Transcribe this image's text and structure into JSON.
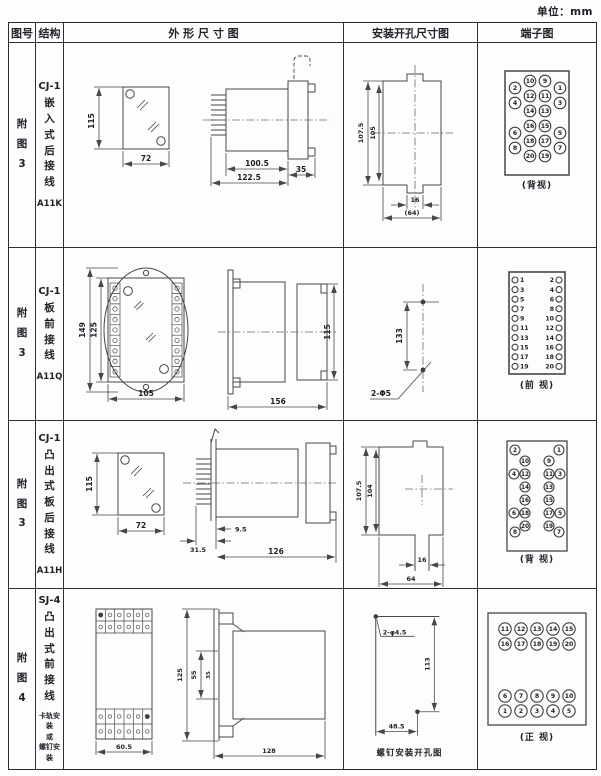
{
  "unit": "单位：mm",
  "header": {
    "fig": "图号",
    "structure": "结构",
    "outline": "外 形 尺 寸 图",
    "install": "安装开孔尺寸图",
    "terminal": "端子图"
  },
  "rows": [
    {
      "fig": "附图3",
      "model": "CJ-1",
      "mounting": "嵌入式后接线",
      "code": "A11K",
      "outline": {
        "h": "115",
        "w": "72",
        "body": "100.5",
        "total": "122.5",
        "flange": "35"
      },
      "install": {
        "outer_h": "107.5",
        "inner_h": "105",
        "slot_w": "16",
        "width": "(64)"
      },
      "terminal": {
        "view": "(背视)",
        "outer_left": [
          "2",
          "4",
          "6",
          "8"
        ],
        "mid_left": [
          "10",
          "12",
          "14",
          "16",
          "18",
          "20"
        ],
        "mid_right": [
          "9",
          "11",
          "13",
          "15",
          "17",
          "19"
        ],
        "outer_right": [
          "1",
          "3",
          "5",
          "7"
        ]
      }
    },
    {
      "fig": "附图3",
      "model": "CJ-1",
      "mounting": "板前接线",
      "code": "A11Q",
      "outline": {
        "outer_h": "149",
        "inner_h": "125",
        "w": "105",
        "len": "156",
        "side_h": "115"
      },
      "install": {
        "dist": "133",
        "holes": "2-Φ5"
      },
      "terminal": {
        "view": "(前 视)",
        "left": [
          "1",
          "3",
          "5",
          "7",
          "9",
          "11",
          "13",
          "15",
          "17",
          "19"
        ],
        "right": [
          "2",
          "4",
          "6",
          "8",
          "10",
          "12",
          "14",
          "16",
          "18",
          "20"
        ]
      }
    },
    {
      "fig": "附图3",
      "model": "CJ-1",
      "mounting": "凸出式板后接线",
      "code": "A11H",
      "outline": {
        "h": "115",
        "w": "72",
        "pins": "31.5",
        "offset": "9.5",
        "len": "126"
      },
      "install": {
        "outer_h": "107.5",
        "inner_h": "104",
        "slot_w": "16",
        "width": "64"
      },
      "terminal": {
        "view": "(背 视)",
        "top_left": "2",
        "top_right": "1",
        "bottom_left": "8",
        "bottom_right": "7",
        "mid_left": [
          "10",
          "12",
          "14",
          "16",
          "18",
          "20"
        ],
        "mid_right": [
          "9",
          "11",
          "13",
          "15",
          "17",
          "19"
        ],
        "outer_left": [
          "4",
          "6"
        ],
        "outer_right": [
          "3",
          "5"
        ]
      }
    },
    {
      "fig": "附图4",
      "model": "SJ-4",
      "mounting": "凸出式前接线",
      "note": [
        "卡轨安装",
        "或",
        "螺钉安装"
      ],
      "outline": {
        "w": "60.5",
        "h": "125",
        "clip": "55",
        "rail": "35",
        "len": "128"
      },
      "install": {
        "holes": "2-φ4.5",
        "v": "113",
        "h": "48.5",
        "caption": "螺钉安装开孔图"
      },
      "terminal": {
        "view": "(正 视)",
        "top": [
          [
            "11",
            "12",
            "13",
            "14",
            "15"
          ],
          [
            "16",
            "17",
            "18",
            "19",
            "20"
          ]
        ],
        "bottom": [
          [
            "6",
            "7",
            "8",
            "9",
            "10"
          ],
          [
            "1",
            "2",
            "3",
            "4",
            "5"
          ]
        ]
      }
    }
  ]
}
